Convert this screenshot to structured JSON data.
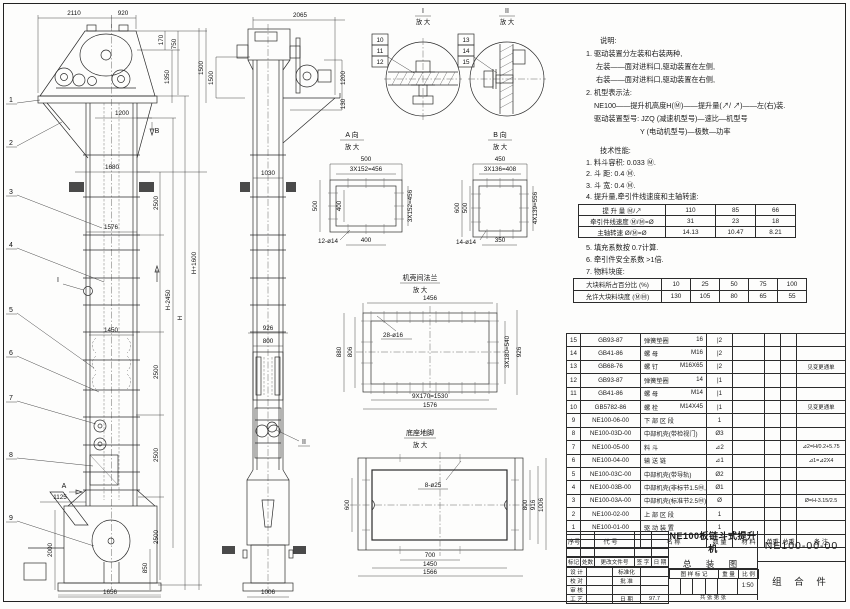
{
  "views": {
    "front": {
      "dims": {
        "top1": "2110",
        "top2": "920",
        "r1": "170",
        "r2": "750",
        "r3": "1350",
        "r4": "1500",
        "w1200": "1200",
        "w1680": "1680",
        "w1576": "1576",
        "w1450": "1450",
        "w1125": "1125",
        "h2000": "2000",
        "h850": "850",
        "w1656": "1656",
        "seg2500": "2500",
        "hminus": "H-2450",
        "h": "H",
        "hplus": "H+1600"
      },
      "balloons": [
        "1",
        "2",
        "3",
        "4",
        "5",
        "6",
        "7",
        "8",
        "9"
      ],
      "marker_a": "A",
      "marker_b": "B",
      "marker_i": "I"
    },
    "side": {
      "dims": {
        "w2065": "2065",
        "h1500": "1500",
        "h1200": "1200",
        "h130": "130",
        "w1030": "1030",
        "w926": "926",
        "w800": "800",
        "w1006": "1006"
      },
      "marker_ii": "II"
    },
    "detail_i": {
      "title": "I",
      "sub": "放 大",
      "balloons": [
        "10",
        "11",
        "12"
      ]
    },
    "detail_ii": {
      "title": "II",
      "sub": "放 大",
      "balloons": [
        "13",
        "14",
        "15"
      ]
    },
    "view_a": {
      "title": "A 向",
      "sub": "放 大",
      "dims": {
        "top": "500",
        "top2": "3X152=456",
        "left": "500",
        "inner": "400",
        "right": "3X152=456",
        "bottom": "400",
        "holes": "12-ø14"
      }
    },
    "view_b": {
      "title": "B 向",
      "sub": "放 大",
      "dims": {
        "top": "450",
        "top2": "3X136=408",
        "left": "600",
        "inner": "500",
        "right": "4X139=556",
        "bottom": "350",
        "holes": "14-ø14"
      }
    },
    "flange": {
      "title": "机壳间法兰",
      "sub": "放 大",
      "dims": {
        "top": "1456",
        "holes": "28-ø16",
        "left1": "880",
        "left2": "806",
        "right1": "3X180=540",
        "right2": "926",
        "bottom1": "9X170=1530",
        "bottom2": "1576"
      }
    },
    "base": {
      "title": "底座地脚",
      "sub": "放 大",
      "dims": {
        "holes": "8-ø25",
        "left": "600",
        "r1": "800",
        "r2": "916",
        "r3": "1006",
        "b1": "700",
        "b2": "1450",
        "b3": "1566"
      }
    }
  },
  "notes": {
    "title": "说明:",
    "lines": [
      "1. 驱动装置分左装和右装两种,",
      "左装——面对进料口,驱动装置在左侧,",
      "右装——面对进料口,驱动装置在右侧,",
      "2. 机型表示法:",
      "NE100——提升机高度H(Ⓜ)——提升量(↗/ ↗)——左(右)装.",
      "驱动装置型号: JZQ (减速机型号)—速比—机型号",
      "Y (电动机型号)—极数—功率"
    ]
  },
  "tech": {
    "title": "技术性能:",
    "items_top": [
      "1. 料斗容积: 0.033 Ⓜ.",
      "2. 斗    距: 0.4 Ⓜ.",
      "3. 斗    宽: 0.4 Ⓜ.",
      "4. 提升量,牵引件线速度和主轴转速:"
    ],
    "capacity_table": {
      "rows": [
        {
          "label": "提 升 量   Ⓜ/↗",
          "c1": "110",
          "c2": "85",
          "c3": "66"
        },
        {
          "label": "牵引件线速度   Ⓜ/Ⓜ=Ø",
          "c1": "31",
          "c2": "23",
          "c3": "18"
        },
        {
          "label": "主轴转速   Ø/Ⓜ=Ø",
          "c1": "14.13",
          "c2": "10.47",
          "c3": "8.21"
        }
      ]
    },
    "items_mid": [
      "5. 填充系数按 0.7计算.",
      "6. 牵引件安全系数 >1倍.",
      "7. 物料块度:"
    ],
    "lump_table": {
      "rows": [
        {
          "label": "大块料所占百分比  (%)",
          "c1": "10",
          "c2": "25",
          "c3": "50",
          "c4": "75",
          "c5": "100"
        },
        {
          "label": "允许大块料块度  (ⓂⓂ)",
          "c1": "130",
          "c2": "105",
          "c3": "80",
          "c4": "65",
          "c5": "55"
        }
      ]
    }
  },
  "bom": {
    "headers": {
      "no": "序号",
      "code": "代    号",
      "name": "名    称",
      "qty": "数 量",
      "mat": "材    料",
      "uw": "单重",
      "tw": "总重",
      "rem": "备  注"
    },
    "rows": [
      {
        "no": "15",
        "code": "GB93-87",
        "name": "弹簧垫圈",
        "spec": "16",
        "qty": "|2",
        "remark": ""
      },
      {
        "no": "14",
        "code": "GB41-86",
        "name": "螺  母",
        "spec": "M16",
        "qty": "|2",
        "remark": ""
      },
      {
        "no": "13",
        "code": "GB68-76",
        "name": "螺  钉",
        "spec": "M16X65",
        "qty": "|2",
        "remark": "见变更通单"
      },
      {
        "no": "12",
        "code": "GB93-87",
        "name": "弹簧垫圈",
        "spec": "14",
        "qty": "|1",
        "remark": ""
      },
      {
        "no": "11",
        "code": "GB41-86",
        "name": "螺  母",
        "spec": "M14",
        "qty": "|1",
        "remark": ""
      },
      {
        "no": "10",
        "code": "GB5782-86",
        "name": "螺  栓",
        "spec": "M14X45",
        "qty": "|1",
        "remark": "见变更通单"
      },
      {
        "no": "9",
        "code": "NE100-06-00",
        "name": "下 部 区 段",
        "spec": "",
        "qty": "1",
        "remark": ""
      },
      {
        "no": "8",
        "code": "NE100-03D-00",
        "name": "中部机壳(带检视门)",
        "spec": "",
        "qty": "Ø3",
        "remark": ""
      },
      {
        "no": "7",
        "code": "NE100-05-00",
        "name": "料  斗",
        "spec": "",
        "qty": "⊿2",
        "remark": "⊿2=H/0.2+5.75"
      },
      {
        "no": "6",
        "code": "NE100-04-00",
        "name": "输 送 链",
        "spec": "",
        "qty": "⊿1",
        "remark": "⊿1=⊿2X4"
      },
      {
        "no": "5",
        "code": "NE100-03C-00",
        "name": "中部机壳(带导轨)",
        "spec": "",
        "qty": "Ø2",
        "remark": ""
      },
      {
        "no": "4",
        "code": "NE100-03B-00",
        "name": "中部机壳(非标节1.5Ⓜ,1Ⓜ)",
        "spec": "",
        "qty": "Ø1",
        "remark": ""
      },
      {
        "no": "3",
        "code": "NE100-03A-00",
        "name": "中部机壳(标准节2.5Ⓜ)",
        "spec": "",
        "qty": "Ø",
        "remark": "Ø=H-3.15/2.5"
      },
      {
        "no": "2",
        "code": "NE100-02-00",
        "name": "上 部 区 段",
        "spec": "",
        "qty": "1",
        "remark": ""
      },
      {
        "no": "1",
        "code": "NE100-01-00",
        "name": "驱 动 装 置",
        "spec": "",
        "qty": "1",
        "remark": ""
      }
    ]
  },
  "title_block": {
    "rev": {
      "mark": "标记",
      "count": "处数",
      "doc": "更改文件号",
      "sign": "签 字",
      "date": "日 期"
    },
    "sig": [
      {
        "l": "设 计",
        "r": "标准化",
        "rv": ""
      },
      {
        "l": "校 对",
        "r": "批 准",
        "rv": ""
      },
      {
        "l": "审 核",
        "r": "",
        "rv": ""
      },
      {
        "l": "工 艺",
        "r": "日 期",
        "rv": "97.7"
      }
    ],
    "stamp": {
      "mark": "图 样 标 记",
      "weight": "重 量",
      "scale": "比 例",
      "scale_value": "1:50",
      "sheets": "共   张 第   张"
    },
    "product": "NE100板链斗式提升机",
    "title2": "总  装  图",
    "drawing_no": "NE100-00-00",
    "part": "组 合 件"
  }
}
